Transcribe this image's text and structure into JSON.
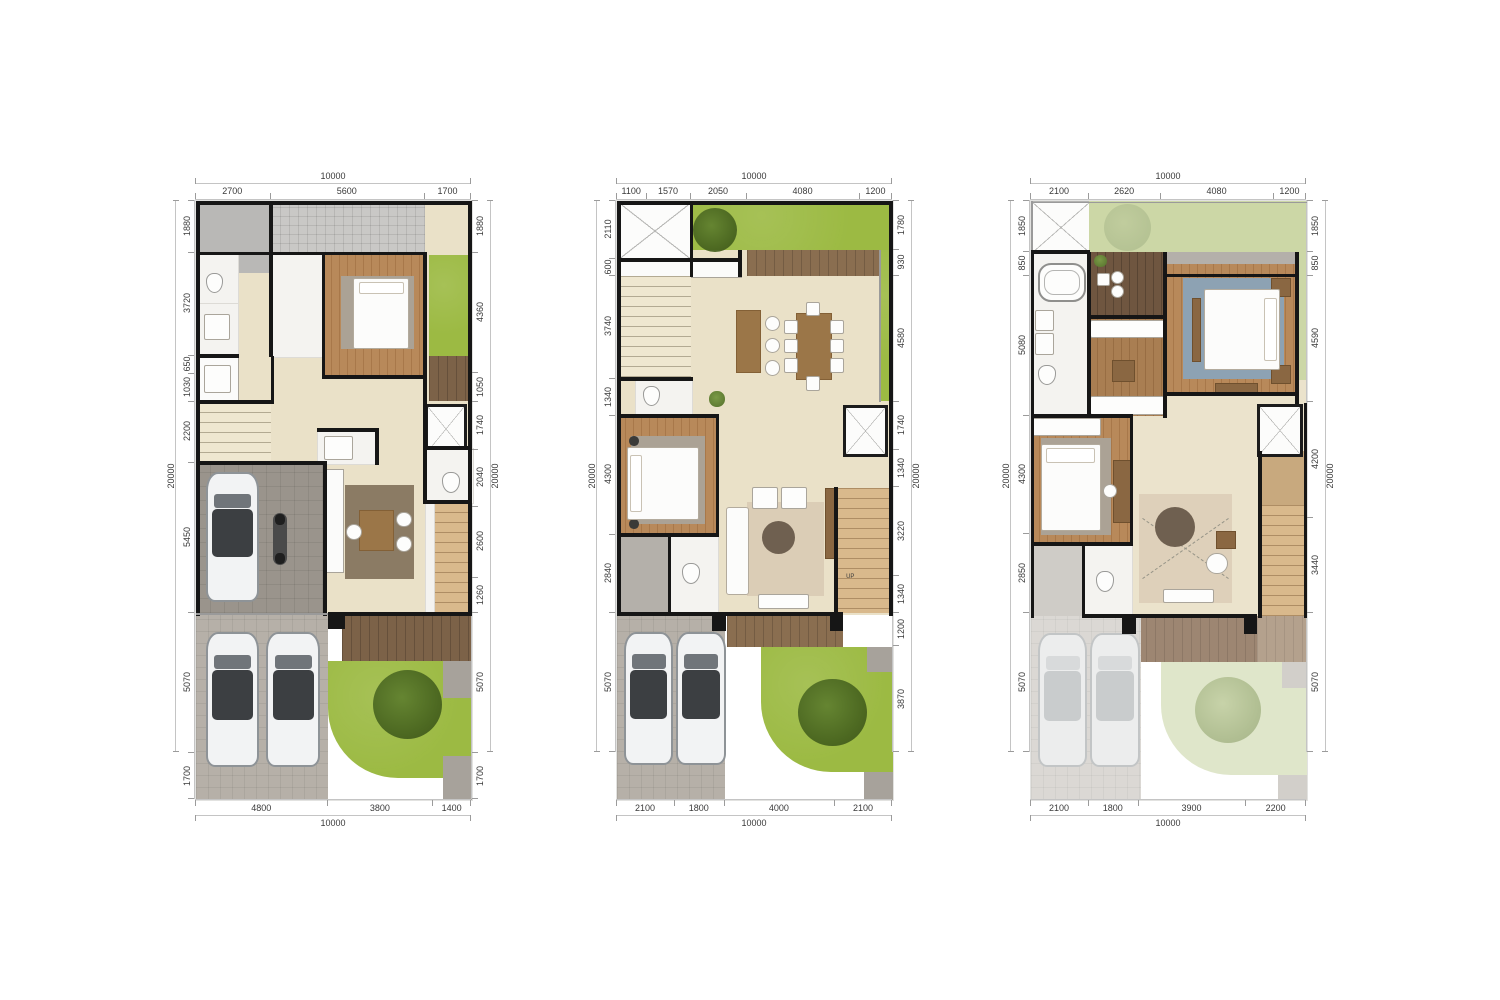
{
  "sheet": {
    "background": "#ffffff",
    "units": "mm"
  },
  "palette": {
    "wall_black": "#161616",
    "travertine": "#eae1c8",
    "wood_floor": "#b8895a",
    "deck_wood": "#7c6248",
    "lawn_green": "#9cba43",
    "pale_lawn": "#ccd7a6",
    "paving_gray": "#b6b0a8",
    "garage_gray": "#9a948c",
    "bath_white": "#f4f3f0",
    "rug_blue": "#8da2b3",
    "dim_text": "#3a3a3a"
  },
  "plans": [
    {
      "name": "plan-a",
      "dim_top_total": 10000,
      "dim_top": [
        2700,
        5600,
        1700
      ],
      "dim_bottom": [
        4800,
        3800,
        1400
      ],
      "dim_bottom_total": 10000,
      "dim_left_total": 20000,
      "dim_left": [
        1880,
        3720,
        650,
        1030,
        2200,
        5450,
        5070,
        1700
      ],
      "dim_right": [
        1880,
        4360,
        1050,
        1740,
        2040,
        2600,
        1260,
        5070,
        1700
      ],
      "dim_right_total": 20000
    },
    {
      "name": "plan-b",
      "dim_top_total": 10000,
      "dim_top": [
        1100,
        1570,
        2050,
        4080,
        1200
      ],
      "dim_bottom": [
        2100,
        1800,
        4000,
        2100
      ],
      "dim_bottom_total": 10000,
      "dim_left_total": 20000,
      "dim_left": [
        2110,
        600,
        3740,
        1340,
        4300,
        2840,
        5070
      ],
      "dim_right": [
        1780,
        930,
        4580,
        1740,
        1340,
        3220,
        1340,
        1200,
        3870
      ],
      "dim_right_total": 20000,
      "stair_label": "UP"
    },
    {
      "name": "plan-c",
      "dim_top_total": 10000,
      "dim_top": [
        2100,
        2620,
        4080,
        1200
      ],
      "dim_bottom": [
        2100,
        1800,
        3900,
        2200
      ],
      "dim_bottom_total": 10000,
      "dim_left_total": 20000,
      "dim_left": [
        1850,
        850,
        5080,
        4300,
        2850,
        5070
      ],
      "dim_right": [
        1850,
        850,
        4590,
        4200,
        3440,
        5070
      ],
      "dim_right_total": 20000
    }
  ]
}
